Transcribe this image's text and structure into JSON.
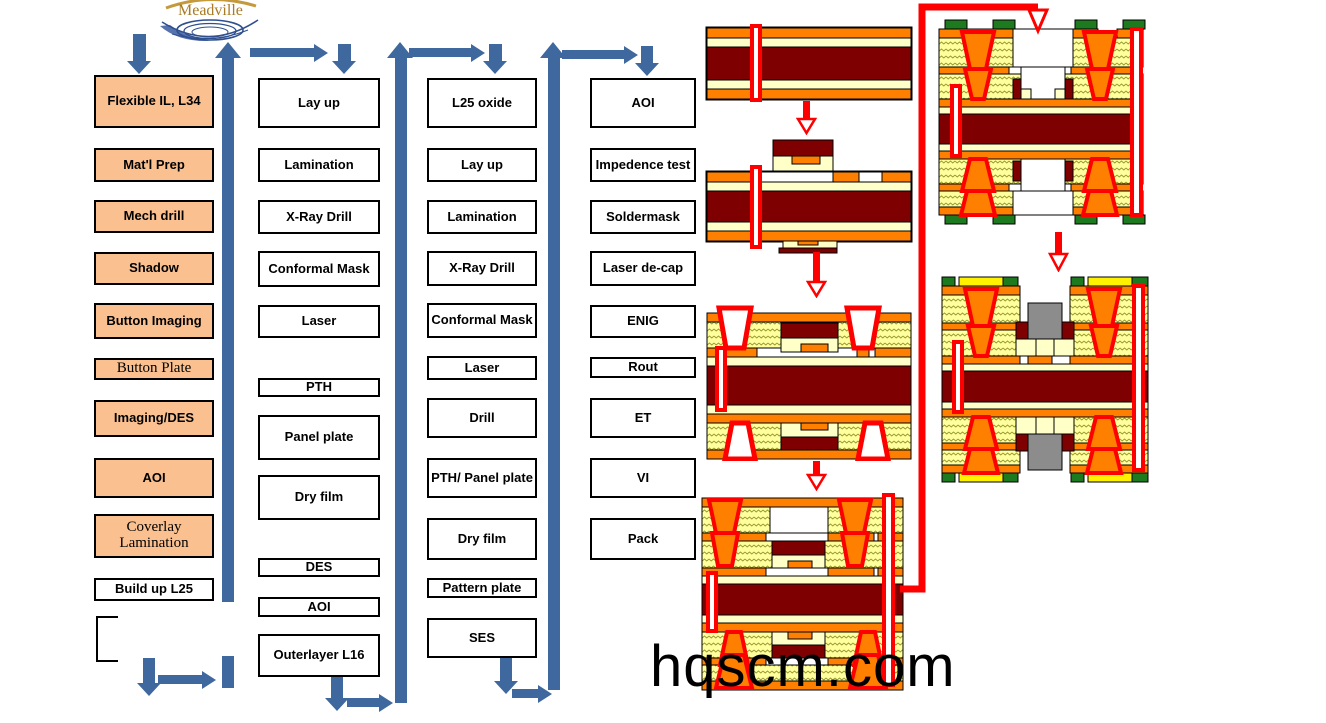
{
  "logo": {
    "text": "Meadville"
  },
  "watermark": "hqscm.com",
  "colors": {
    "flow_box_fill": "#FAC090",
    "connector_blue": "#3F689E",
    "copper_orange": "#FF7F00",
    "core_dark_red": "#7F0000",
    "dielectric_cream": "#FFFFC8",
    "prepreg_yellow": "#FFFF9E",
    "via_red": "#FF0000",
    "pad_green": "#1E7A1E",
    "pad_yellow": "#FFF200",
    "component_gray": "#8C8C8C"
  },
  "columns": [
    {
      "boxes": [
        {
          "label": "Flexible IL, L34"
        },
        {
          "label": "Mat'l Prep"
        },
        {
          "label": "Mech drill"
        },
        {
          "label": "Shadow"
        },
        {
          "label": "Button Imaging"
        },
        {
          "label": "Button Plate"
        },
        {
          "label": "Imaging/DES"
        },
        {
          "label": "AOI"
        },
        {
          "label": "Coverlay Lamination"
        },
        {
          "label": "Build up L25"
        }
      ]
    },
    {
      "boxes": [
        {
          "label": "Lay up"
        },
        {
          "label": "Lamination"
        },
        {
          "label": "X-Ray Drill"
        },
        {
          "label": "Conformal Mask"
        },
        {
          "label": "Laser"
        },
        {
          "label": "PTH"
        },
        {
          "label": "Panel plate"
        },
        {
          "label": "Dry film"
        },
        {
          "label": "DES"
        },
        {
          "label": "AOI"
        },
        {
          "label": "Outerlayer L16"
        }
      ]
    },
    {
      "boxes": [
        {
          "label": "L25 oxide"
        },
        {
          "label": "Lay up"
        },
        {
          "label": "Lamination"
        },
        {
          "label": "X-Ray Drill"
        },
        {
          "label": "Conformal Mask"
        },
        {
          "label": "Laser"
        },
        {
          "label": "Drill"
        },
        {
          "label": "PTH/ Panel plate"
        },
        {
          "label": "Dry film"
        },
        {
          "label": "Pattern plate"
        },
        {
          "label": "SES"
        }
      ]
    },
    {
      "boxes": [
        {
          "label": "AOI"
        },
        {
          "label": "Impedence test"
        },
        {
          "label": "Soldermask"
        },
        {
          "label": "Laser de-cap"
        },
        {
          "label": "ENIG"
        },
        {
          "label": "Rout"
        },
        {
          "label": "ET"
        },
        {
          "label": "VI"
        },
        {
          "label": "Pack"
        }
      ]
    }
  ]
}
